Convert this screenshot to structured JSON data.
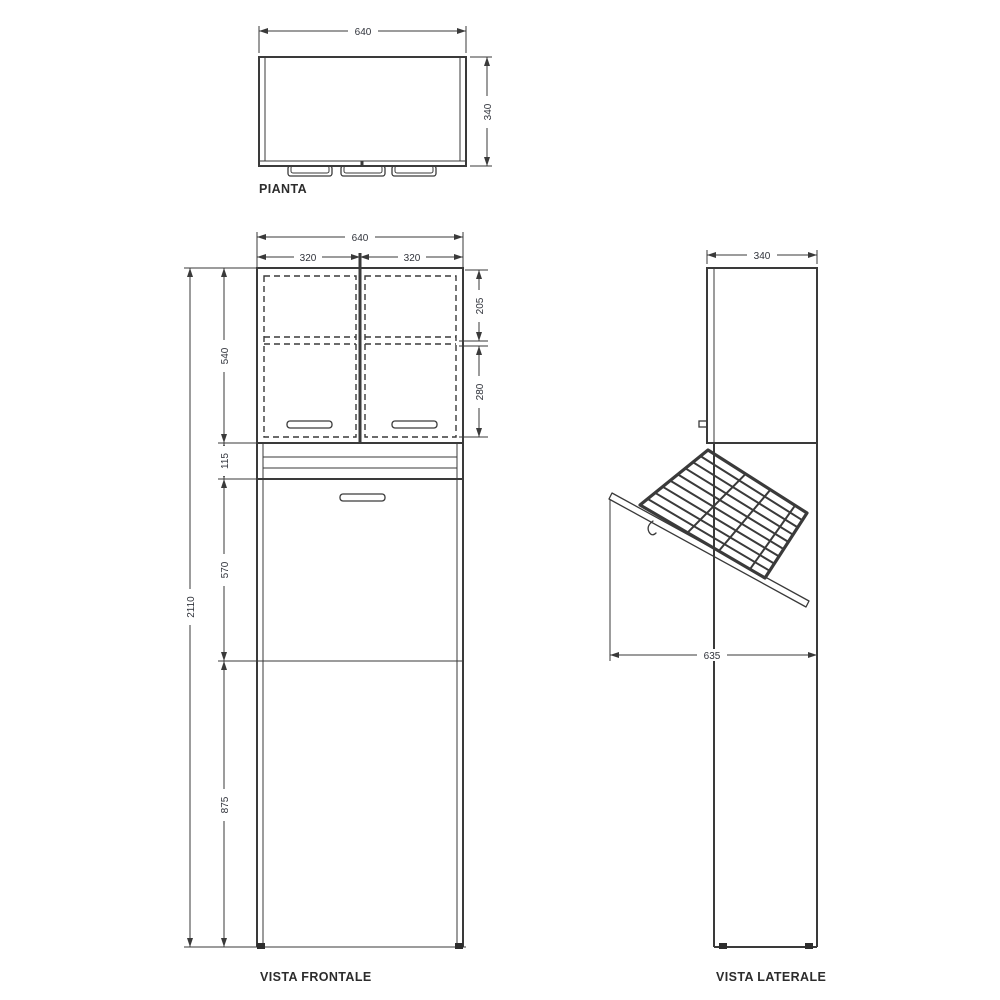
{
  "plan": {
    "title": "PIANTA",
    "dim_width": "640",
    "dim_depth": "340"
  },
  "front": {
    "title": "VISTA FRONTALE",
    "dim_width": "640",
    "dim_door_left": "320",
    "dim_door_right": "320",
    "dim_upper_height": "540",
    "dim_shelf_upper": "205",
    "dim_shelf_lower": "280",
    "dim_band": "115",
    "dim_mid_door": "570",
    "dim_lower": "875",
    "dim_total_height": "2110"
  },
  "side": {
    "title": "VISTA LATERALE",
    "dim_depth": "340",
    "dim_open_door": "635"
  },
  "colors": {
    "line": "#3a3a3a",
    "background": "#ffffff"
  }
}
